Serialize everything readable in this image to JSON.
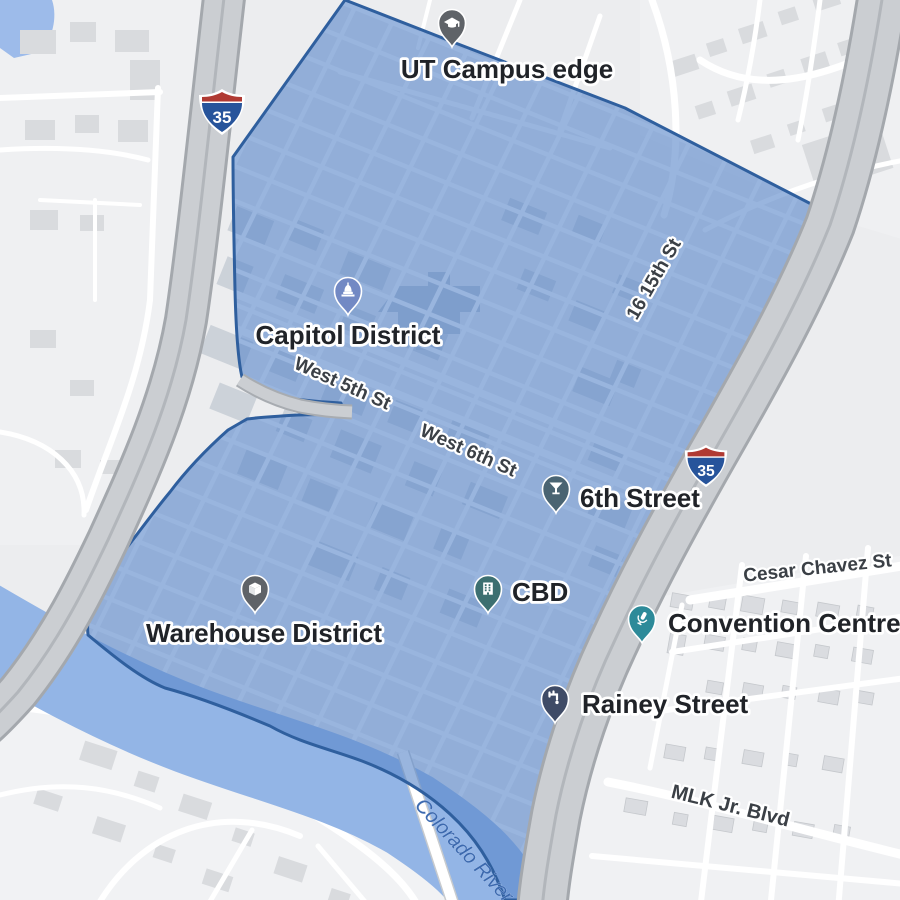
{
  "map_type": "district-overlay-map",
  "markers": [
    {
      "label": "UT Campus edge",
      "icon": "graduation-cap-icon",
      "color": "#5f6368"
    },
    {
      "label": "Capitol District",
      "icon": "capitol-dome-icon",
      "color": "#7289c4"
    },
    {
      "label": "6th Street",
      "icon": "martini-icon",
      "color": "#4a6472"
    },
    {
      "label": "CBD",
      "icon": "building-icon",
      "color": "#3c6f70"
    },
    {
      "label": "Warehouse District",
      "icon": "package-box-icon",
      "color": "#5f6368"
    },
    {
      "label": "Convention Centre",
      "icon": "microphone-icon",
      "color": "#2d8a99"
    },
    {
      "label": "Rainey Street",
      "icon": "tap-icon",
      "color": "#3f4b66"
    }
  ],
  "street_labels": [
    {
      "text": "West 5th St"
    },
    {
      "text": "West 6th St"
    },
    {
      "text": "16 15th St"
    },
    {
      "text": "Cesar Chavez St"
    },
    {
      "text": "MLK Jr. Blvd"
    }
  ],
  "water_labels": [
    {
      "text": "Colorado River"
    }
  ],
  "shields": [
    {
      "route": "35"
    },
    {
      "route": "35"
    }
  ],
  "colors": {
    "district_fill": "#5b87c9",
    "district_border": "#2f5f9e",
    "river": "#93b5e6",
    "pond": "#9dbbea",
    "highway_fill": "#cbced2",
    "highway_casing": "#a4a8ad",
    "base": "#ecedef",
    "shield_blue": "#27549b",
    "shield_red": "#b03a33"
  }
}
